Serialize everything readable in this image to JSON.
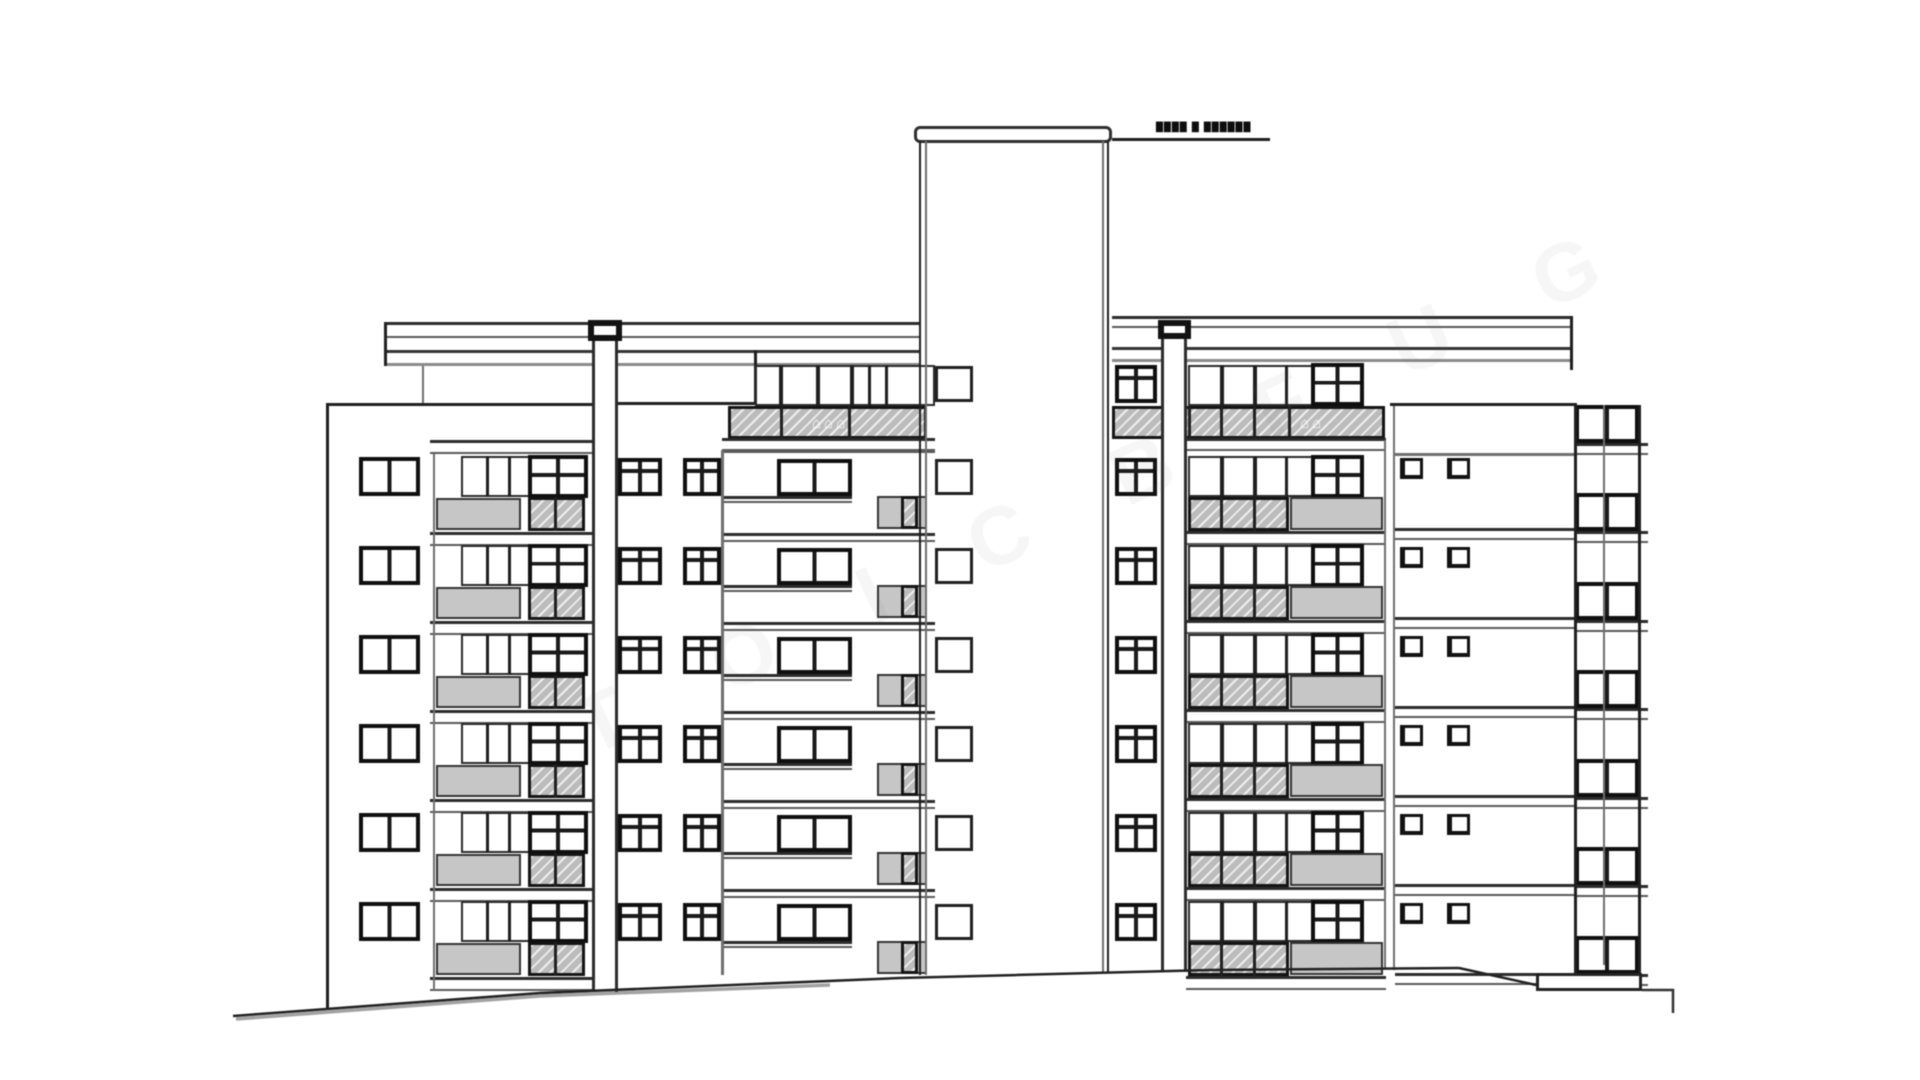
{
  "annotation": {
    "roof_label": "████ █ ██████"
  },
  "watermark": {
    "letters": "T O I C B F U G",
    "icons": "⌂⌂⌂",
    "icons_small": "⌂⌂"
  },
  "drawing": {
    "rows_main": [
      458,
      547,
      636,
      725,
      814,
      903
    ],
    "rows_all": [
      365,
      458,
      547,
      636,
      725,
      814,
      903
    ],
    "rows_right_block": [
      405,
      493,
      582,
      670,
      759,
      847,
      936
    ],
    "repeats": [
      {
        "rows": "rows_main",
        "shapes": [
          {
            "n": "left-block-window",
            "c": "f-dark w2",
            "x": 359,
            "dy": -1,
            "w": 61,
            "h": 39
          },
          {
            "n": "left-wing-window-band",
            "c": "f-thin",
            "x": 461,
            "dy": -2,
            "w": 127,
            "h": 41
          },
          {
            "n": "mullion",
            "c": "bar",
            "x": 486,
            "dy": -2,
            "w": 3,
            "h": 41
          },
          {
            "n": "mullion",
            "c": "bar",
            "x": 508,
            "dy": -2,
            "w": 3,
            "h": 41
          },
          {
            "n": "left-wing-dark-window",
            "c": "f-dark w2x2",
            "x": 528,
            "dy": -3,
            "w": 60,
            "h": 43
          },
          {
            "n": "left-wing-balcony-panel",
            "c": "gray",
            "x": 436,
            "dy": 40,
            "w": 85,
            "h": 32
          },
          {
            "n": "left-wing-balcony-hatch",
            "c": "hatch",
            "x": 528,
            "dy": 39,
            "w": 57,
            "h": 34
          },
          {
            "n": "hatch-divider",
            "c": "bar",
            "x": 554,
            "dy": 39,
            "w": 3,
            "h": 34
          },
          {
            "n": "left-wing-slab",
            "c": "slab",
            "x": 430,
            "dy": 74,
            "w": 164,
            "h": 14
          },
          {
            "n": "mid-left-slab",
            "c": "slab",
            "x": 722,
            "dy": -14,
            "w": 213,
            "h": 9
          },
          {
            "n": "mid-left-window-a",
            "c": "f-dark w4",
            "x": 618,
            "dy": 0,
            "w": 44,
            "h": 38
          },
          {
            "n": "mid-left-window-b",
            "c": "f-dark w4",
            "x": 683,
            "dy": 0,
            "w": 38,
            "h": 38
          },
          {
            "n": "mid-left-wide-window",
            "c": "f-dark w2",
            "x": 777,
            "dy": 1,
            "w": 75,
            "h": 37
          },
          {
            "n": "mid-left-sill",
            "c": "slab",
            "x": 722,
            "dy": 38,
            "w": 130,
            "h": 7
          },
          {
            "n": "mid-left-balcony-panel",
            "c": "gray",
            "x": 877,
            "dy": 38,
            "w": 50,
            "h": 33
          },
          {
            "n": "mid-left-balcony-hatch",
            "c": "hatch",
            "x": 901,
            "dy": 38,
            "w": 17,
            "h": 33
          },
          {
            "n": "right-wing-window-band",
            "c": "f-thin",
            "x": 1188,
            "dy": -2,
            "w": 130,
            "h": 41
          },
          {
            "n": "mullion",
            "c": "bar",
            "x": 1220,
            "dy": -2,
            "w": 4,
            "h": 41
          },
          {
            "n": "mullion",
            "c": "bar",
            "x": 1253,
            "dy": -2,
            "w": 4,
            "h": 41
          },
          {
            "n": "mullion",
            "c": "bar",
            "x": 1285,
            "dy": -2,
            "w": 3,
            "h": 41
          },
          {
            "n": "right-wing-dark-window",
            "c": "f-dark w2x2",
            "x": 1311,
            "dy": -3,
            "w": 53,
            "h": 43
          },
          {
            "n": "right-wing-balcony-hatch",
            "c": "hatch",
            "x": 1188,
            "dy": 39,
            "w": 101,
            "h": 34
          },
          {
            "n": "hatch-divider",
            "c": "bar",
            "x": 1220,
            "dy": 39,
            "w": 3,
            "h": 34
          },
          {
            "n": "hatch-divider",
            "c": "bar",
            "x": 1253,
            "dy": 39,
            "w": 3,
            "h": 34
          },
          {
            "n": "right-wing-balcony-panel",
            "c": "gray",
            "x": 1290,
            "dy": 39,
            "w": 93,
            "h": 33
          },
          {
            "n": "right-wing-slab",
            "c": "slab",
            "x": 1186,
            "dy": 73,
            "w": 200,
            "h": 14
          },
          {
            "n": "white-section-vent-a",
            "c": "f-sq",
            "x": 1400,
            "dy": 0,
            "w": 23,
            "h": 21
          },
          {
            "n": "white-section-vent-b",
            "c": "f-sq",
            "x": 1447,
            "dy": 0,
            "w": 23,
            "h": 21
          },
          {
            "n": "white-section-slab",
            "c": "slab",
            "x": 1395,
            "dy": 70,
            "w": 182,
            "h": 12
          }
        ]
      },
      {
        "rows": "rows_all",
        "shapes": [
          {
            "n": "tower-left-window",
            "c": "f-mid",
            "x": 935,
            "dy": 1,
            "w": 38,
            "h": 36
          },
          {
            "n": "tower-right-window",
            "c": "f-dark w4",
            "x": 1115,
            "dy": 0,
            "w": 42,
            "h": 38
          }
        ]
      },
      {
        "rows": "rows_right_block",
        "shapes": [
          {
            "n": "right-block-window",
            "c": "f-dark w2",
            "x": 1575,
            "dy": 0,
            "w": 64,
            "h": 38
          },
          {
            "n": "right-block-sill",
            "c": "slab",
            "x": 1575,
            "dy": 38,
            "w": 73,
            "h": 12
          }
        ]
      }
    ],
    "static": [
      {
        "n": "roof-band-upper-left",
        "c": "slab",
        "x": 385,
        "y": 322,
        "w": 536,
        "h": 16
      },
      {
        "n": "roof-band-lower-left",
        "c": "band2",
        "x": 385,
        "y": 350,
        "w": 536,
        "h": 16
      },
      {
        "n": "roof-edge-left",
        "c": "bar",
        "x": 384,
        "y": 322,
        "w": 3,
        "h": 44
      },
      {
        "n": "roof-line-left",
        "c": "bar",
        "x": 593,
        "y": 402,
        "w": 164,
        "h": 3
      },
      {
        "n": "roof-step-bar",
        "c": "bar",
        "x": 754,
        "y": 350,
        "w": 3,
        "h": 55
      },
      {
        "n": "roof-band-upper-right",
        "c": "slab",
        "x": 1112,
        "y": 316,
        "w": 461,
        "h": 12
      },
      {
        "n": "roof-band-lower-right",
        "c": "band2",
        "x": 1112,
        "y": 347,
        "w": 461,
        "h": 15
      },
      {
        "n": "roof-edge-right",
        "c": "bar",
        "x": 1570,
        "y": 316,
        "w": 3,
        "h": 54
      },
      {
        "n": "left-block-top-line",
        "c": "bar",
        "x": 326,
        "y": 403,
        "w": 269,
        "h": 3
      },
      {
        "n": "left-block-left-wall",
        "c": "bar",
        "x": 326,
        "y": 404,
        "w": 3,
        "h": 604
      },
      {
        "n": "left-block-roof-connector",
        "c": "bar-soft",
        "x": 422,
        "y": 366,
        "w": 2,
        "h": 37
      },
      {
        "n": "left-wing-left-wall",
        "c": "bar-soft",
        "x": 433,
        "y": 442,
        "w": 2,
        "h": 548
      },
      {
        "n": "left-wing-top-slab",
        "c": "slab",
        "x": 430,
        "y": 440,
        "w": 164,
        "h": 14
      },
      {
        "n": "mid-left-top-window-band",
        "c": "f-thin",
        "x": 755,
        "y": 365,
        "w": 180,
        "h": 41
      },
      {
        "n": "mullion",
        "c": "bar",
        "x": 779,
        "y": 365,
        "w": 4,
        "h": 41
      },
      {
        "n": "mullion",
        "c": "bar",
        "x": 816,
        "y": 365,
        "w": 4,
        "h": 41
      },
      {
        "n": "mullion",
        "c": "bar",
        "x": 850,
        "y": 365,
        "w": 4,
        "h": 41
      },
      {
        "n": "mullion",
        "c": "bar",
        "x": 868,
        "y": 365,
        "w": 3,
        "h": 41
      },
      {
        "n": "mullion",
        "c": "bar",
        "x": 885,
        "y": 365,
        "w": 3,
        "h": 41
      },
      {
        "n": "mid-left-top-hatch",
        "c": "hatch",
        "x": 728,
        "y": 406,
        "w": 199,
        "h": 33
      },
      {
        "n": "hatch-divider",
        "c": "bar",
        "x": 780,
        "y": 406,
        "w": 3,
        "h": 33
      },
      {
        "n": "hatch-divider",
        "c": "bar",
        "x": 848,
        "y": 406,
        "w": 3,
        "h": 33
      },
      {
        "n": "mid-left-top-slab",
        "c": "slab",
        "x": 722,
        "y": 438,
        "w": 213,
        "h": 13
      },
      {
        "n": "mid-left-wall",
        "c": "bar-soft",
        "x": 721,
        "y": 450,
        "w": 3,
        "h": 525
      },
      {
        "n": "right-wing-top-band",
        "c": "f-thin",
        "x": 1188,
        "y": 365,
        "w": 130,
        "h": 41
      },
      {
        "n": "mullion",
        "c": "bar",
        "x": 1220,
        "y": 365,
        "w": 4,
        "h": 41
      },
      {
        "n": "mullion",
        "c": "bar",
        "x": 1253,
        "y": 365,
        "w": 4,
        "h": 41
      },
      {
        "n": "mullion",
        "c": "bar",
        "x": 1285,
        "y": 365,
        "w": 3,
        "h": 41
      },
      {
        "n": "right-wing-top-dark-window",
        "c": "f-dark w2x2",
        "x": 1311,
        "y": 363,
        "w": 53,
        "h": 43
      },
      {
        "n": "right-wing-top-hatch",
        "c": "hatch",
        "x": 1112,
        "y": 406,
        "w": 273,
        "h": 33
      },
      {
        "n": "hatch-divider",
        "c": "bar",
        "x": 1188,
        "y": 406,
        "w": 3,
        "h": 33
      },
      {
        "n": "hatch-divider",
        "c": "bar",
        "x": 1220,
        "y": 406,
        "w": 3,
        "h": 33
      },
      {
        "n": "hatch-divider",
        "c": "bar",
        "x": 1253,
        "y": 406,
        "w": 3,
        "h": 33
      },
      {
        "n": "hatch-divider",
        "c": "bar",
        "x": 1288,
        "y": 406,
        "w": 3,
        "h": 33
      },
      {
        "n": "right-wing-top-slab",
        "c": "slab",
        "x": 1186,
        "y": 438,
        "w": 200,
        "h": 13
      },
      {
        "n": "right-wing-right-wall",
        "c": "bar-soft",
        "x": 1384,
        "y": 440,
        "w": 2,
        "h": 528
      },
      {
        "n": "white-section-left-wall",
        "c": "bar-soft",
        "x": 1393,
        "y": 405,
        "w": 2,
        "h": 565
      },
      {
        "n": "white-section-top-line",
        "c": "bar",
        "x": 1390,
        "y": 403,
        "w": 187,
        "h": 3
      },
      {
        "n": "white-section-upper-line",
        "c": "bar-soft",
        "x": 1393,
        "y": 453,
        "w": 184,
        "h": 3
      },
      {
        "n": "right-block-left-wall",
        "c": "bar",
        "x": 1574,
        "y": 405,
        "w": 3,
        "h": 568
      },
      {
        "n": "right-block-mid-wall",
        "c": "bar-soft",
        "x": 1603,
        "y": 405,
        "w": 2,
        "h": 560
      },
      {
        "n": "right-block-right-wall",
        "c": "bar",
        "x": 1638,
        "y": 405,
        "w": 3,
        "h": 568
      },
      {
        "n": "tower-cap",
        "c": "tcap",
        "x": 914,
        "y": 126,
        "w": 198,
        "h": 17
      },
      {
        "n": "tower-left-wall-outer",
        "c": "bar",
        "x": 919,
        "y": 141,
        "w": 2,
        "h": 834
      },
      {
        "n": "tower-left-wall-inner",
        "c": "bar-soft",
        "x": 925,
        "y": 141,
        "w": 2,
        "h": 834
      },
      {
        "n": "tower-right-wall-inner",
        "c": "bar-soft",
        "x": 1102,
        "y": 141,
        "w": 2,
        "h": 832
      },
      {
        "n": "tower-right-wall-outer",
        "c": "bar",
        "x": 1107,
        "y": 141,
        "w": 2,
        "h": 832
      },
      {
        "n": "roof-leader-line",
        "c": "bar",
        "x": 1112,
        "y": 138,
        "w": 158,
        "h": 3
      },
      {
        "n": "left-pilaster-cap",
        "c": "cap",
        "x": 588,
        "y": 320,
        "w": 34,
        "h": 21
      },
      {
        "n": "left-pilaster",
        "c": "pill",
        "x": 592,
        "y": 341,
        "w": 26,
        "h": 651
      },
      {
        "n": "right-pilaster-cap",
        "c": "cap",
        "x": 1158,
        "y": 320,
        "w": 33,
        "h": 19
      },
      {
        "n": "right-pilaster",
        "c": "pill",
        "x": 1161,
        "y": 339,
        "w": 26,
        "h": 633
      },
      {
        "n": "base-platform",
        "c": "plat",
        "x": 1536,
        "y": 973,
        "w": 106,
        "h": 18
      }
    ],
    "ground": [
      {
        "n": "ground-line-main",
        "d": "M233,1016 L540,993 L900,978 L1210,970 L1459,968",
        "w": 2.5,
        "s": "#222222",
        "o": 1
      },
      {
        "n": "ground-line-shadow",
        "d": "M236,1019 L540,996 L830,985",
        "w": 3.5,
        "s": "#555555",
        "o": 0.55
      },
      {
        "n": "ground-line-right",
        "d": "M1459,968 L1536,985",
        "w": 2.5,
        "s": "#222222",
        "o": 1
      },
      {
        "n": "ground-line-step",
        "d": "M1642,990 L1673,990 L1673,1013",
        "w": 2.5,
        "s": "#333333",
        "o": 1
      }
    ]
  }
}
